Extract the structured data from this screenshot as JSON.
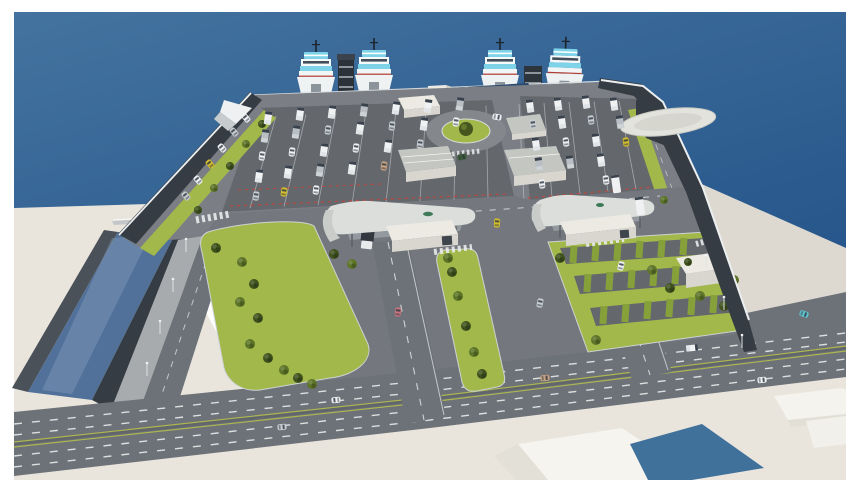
{
  "meta": {
    "title": "Aerial 3D architectural rendering of a ferry terminal and vehicle marshalling port",
    "type": "3d-render",
    "view": "high-angle aerial perspective over sea",
    "visible_text": "none"
  },
  "palette": {
    "frame-white": "#ffffff",
    "sea-top": "#44739f",
    "sea-deep": "#26568b",
    "canal-water": "#51719a",
    "cream-ground": "#e9e5dd",
    "cream-shadow": "#ddd9d1",
    "asphalt-lot": "#64686d",
    "asphalt-road": "#7b7f85",
    "asphalt-main": "#6d7278",
    "asphalt-apron": "#74787e",
    "sidewalk": "#a7abae",
    "wall-dark": "#363c43",
    "wall-mid": "#4a5159",
    "wall-cap": "#eceff0",
    "grass": "#a3b84a",
    "grass-dark": "#86a03a",
    "bush-dark": "#3f521e",
    "bush-mid": "#5d7429",
    "roof-light": "#c4c6c2",
    "roof-white": "#eceae2",
    "bldg-wall": "#d8d6cf",
    "solar-roof": "#2c4a6e",
    "blue-roof": "#40719b",
    "ferry-white": "#f4f7f8",
    "ferry-cyan": "#7ed3e8",
    "ferry-dark": "#22303c",
    "ferry-red": "#b03a30",
    "marking-white": "#e9ebec",
    "marking-red": "#b84a42",
    "median-yellow": "#b9c24a",
    "taxi-yellow": "#d2bd2f",
    "car-teal": "#62c2cb",
    "car-red": "#c4747e",
    "car-tan": "#c8a383",
    "car-green": "#3f5c3a",
    "vehicle-white": "#eff1f2",
    "vehicle-gray": "#b9bfc4",
    "car-silver": "#c9ced2",
    "helipad": "#e3e3dd"
  },
  "scene": {
    "sea": "deep blue sea filling upper background, lighter toward top-left",
    "ferries": {
      "count": 4,
      "style": "white ro-ro ferries with cyan stripe superstructures, dark masts, docked bow-on in two pairs"
    },
    "berth": {
      "loading_towers": 2,
      "pier_terminal_building": "long building with dark-blue solar-panel roof",
      "gateway_towers": 2,
      "pier_sheds": 2
    },
    "breakwaters": {
      "left": "dark seawall with white wave-deflector wedge",
      "right": "long dark seawall with white cap descending to the boulevard"
    },
    "stone_pad": "white oval rubble/helipad pad outside right seawall",
    "marshalling_lots": {
      "left_vehicles": 28,
      "right_vehicles": 17,
      "buses": 2,
      "lane_lines": "white",
      "queue_stops": "red dashed"
    },
    "roundabout": {
      "count": 1,
      "center": "grass with single tree"
    },
    "toll_canopies": {
      "count": 2,
      "style": "curved light-gray airfoil roofs with green logo dot, white control booths",
      "truck_under_left_canopy": 1
    },
    "canal": "dark water channel cutting through cream apron at lower left with footbridge",
    "green_islands": 3,
    "bushes_total": 36,
    "roads": {
      "main_boulevard": "wide dual carriageway with white dashes and yellow-green median",
      "access_roads": 2,
      "perimeter_roads": 2,
      "crosswalks": 5
    },
    "road_vehicles": 12,
    "street_lamps": 7,
    "foreground_buildings": {
      "white_blocks": 3,
      "blue_roof_sections": 1
    }
  }
}
